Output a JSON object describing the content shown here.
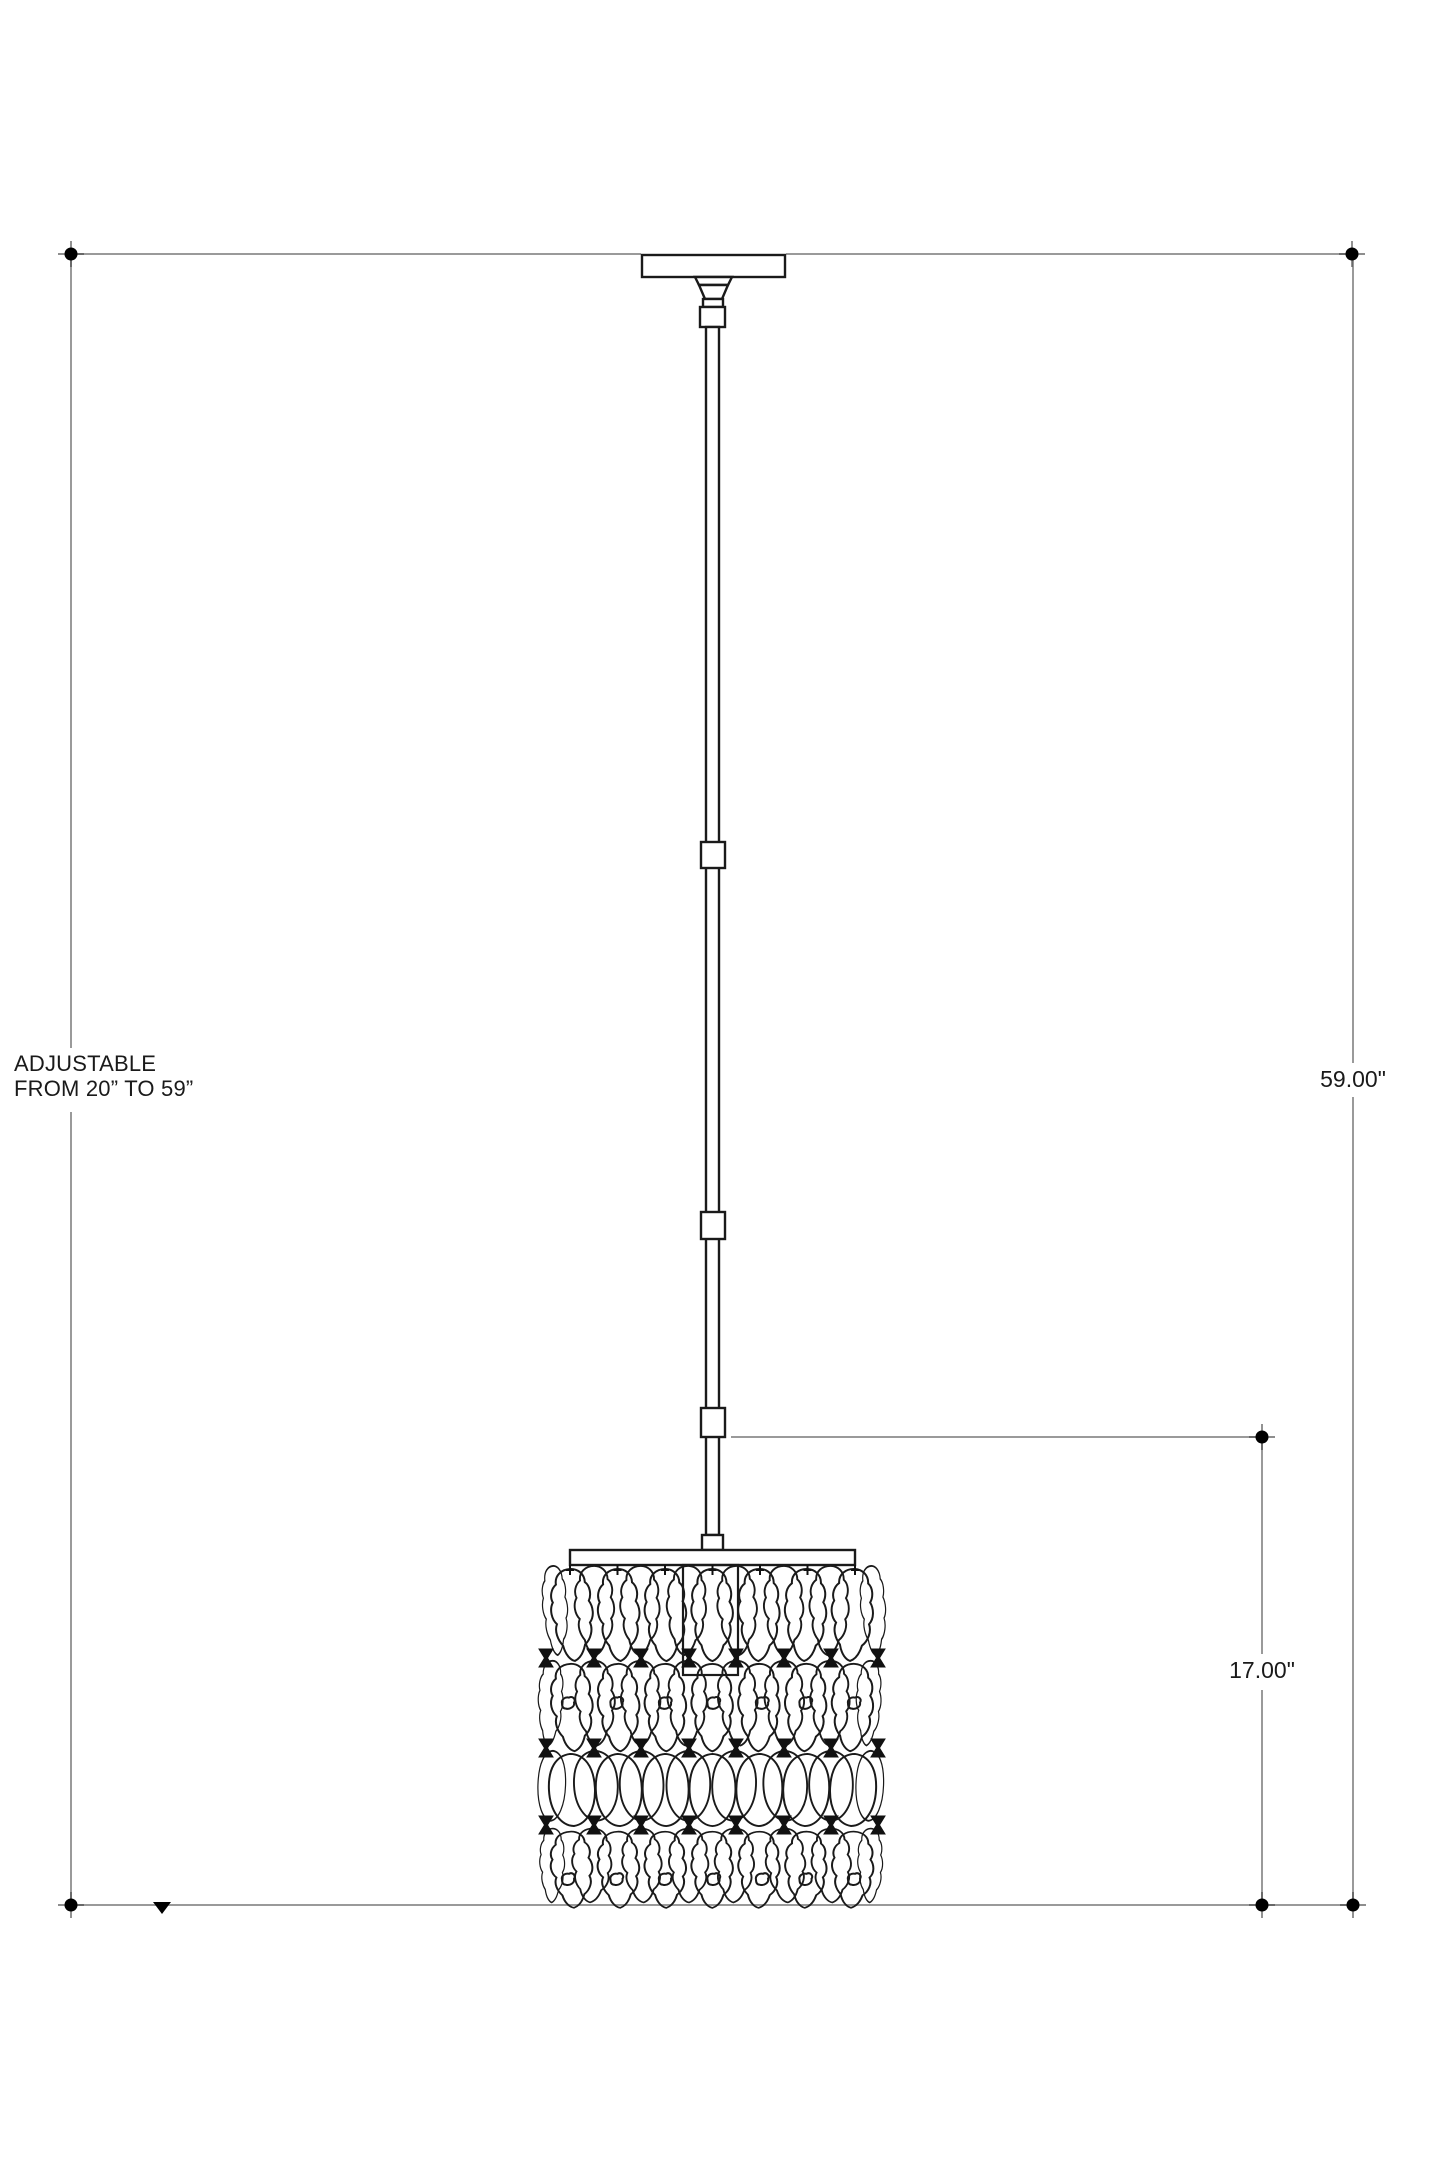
{
  "annotations": {
    "adjustable": {
      "line1": "ADJUSTABLE",
      "line2": "FROM 20” TO 59”"
    },
    "overall_height": "59.00\"",
    "fixture_height": "17.00\""
  },
  "colors": {
    "background": "#ffffff",
    "drawing_line": "#1a1a1a",
    "dimension_line": "#9a9a9a",
    "marker": "#000000",
    "text": "#1a1a1a"
  }
}
